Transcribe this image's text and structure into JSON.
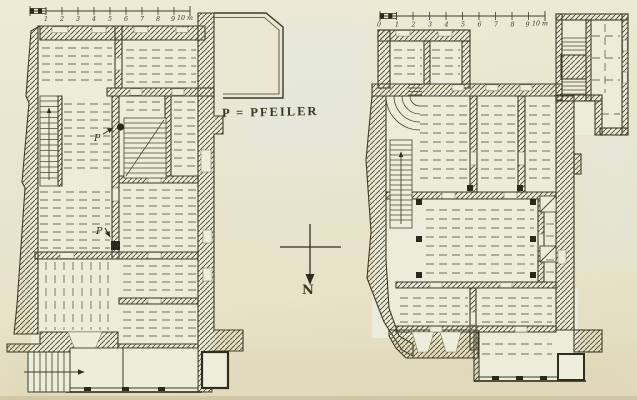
{
  "figure": {
    "legend_label": "P = PFEILER",
    "compass_label": "N",
    "left_plan": {
      "scale_labels": [
        "1",
        "2",
        "3",
        "4",
        "5",
        "6",
        "7",
        "8",
        "9",
        "10 m"
      ],
      "pillar_markers": [
        "P",
        "P"
      ]
    },
    "right_plan": {
      "scale_labels": [
        "0",
        "1",
        "2",
        "3",
        "4",
        "5",
        "6",
        "7",
        "8",
        "9",
        "10 m"
      ]
    },
    "colors": {
      "paper": "#e9e5cd",
      "room_fill": "#ebecd9",
      "ink": "#3e3b2a",
      "hatch": "#5c5840",
      "dash": "#73704f",
      "dark_fill": "#2b291b"
    }
  }
}
